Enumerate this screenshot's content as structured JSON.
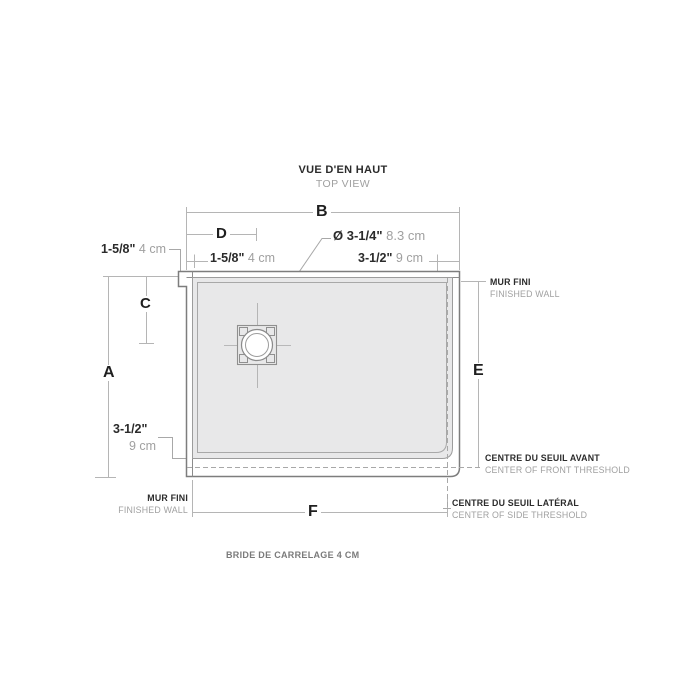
{
  "title": {
    "primary": "VUE D'EN HAUT",
    "secondary": "TOP VIEW"
  },
  "dimension_letters": {
    "a": "A",
    "b": "B",
    "c": "C",
    "d": "D",
    "e": "E",
    "f": "F"
  },
  "measurements": {
    "left_flange": {
      "imperial": "1-5/8\"",
      "metric": "4 cm"
    },
    "top_flange": {
      "imperial": "1-5/8\"",
      "metric": "4 cm"
    },
    "drain_diameter": {
      "imperial": "Ø 3-1/4\"",
      "metric": "8.3 cm"
    },
    "side_threshold_offset": {
      "imperial": "3-1/2\"",
      "metric": "9 cm"
    },
    "front_threshold_offset": {
      "imperial": "3-1/2\"",
      "metric": "9 cm"
    }
  },
  "callouts": {
    "finished_wall_right": {
      "fr": "MUR FINI",
      "en": "FINISHED WALL"
    },
    "finished_wall_left": {
      "fr": "MUR FINI",
      "en": "FINISHED WALL"
    },
    "front_threshold": {
      "fr": "CENTRE DU SEUIL AVANT",
      "en": "CENTER OF FRONT THRESHOLD"
    },
    "side_threshold": {
      "fr": "CENTRE DU SEUIL LATÉRAL",
      "en": "CENTER OF SIDE THRESHOLD"
    },
    "clipped_note": "BRIDE DE CARRELAGE 4 CM"
  },
  "colors": {
    "floor_fill": "#e8e8e9",
    "drawing_line": "#7d7d7d",
    "dimension_line": "#b5b5b5",
    "dashed_line": "#a8a8a8",
    "text_dark": "#2b2b2b",
    "text_gray": "#a0a0a0"
  }
}
